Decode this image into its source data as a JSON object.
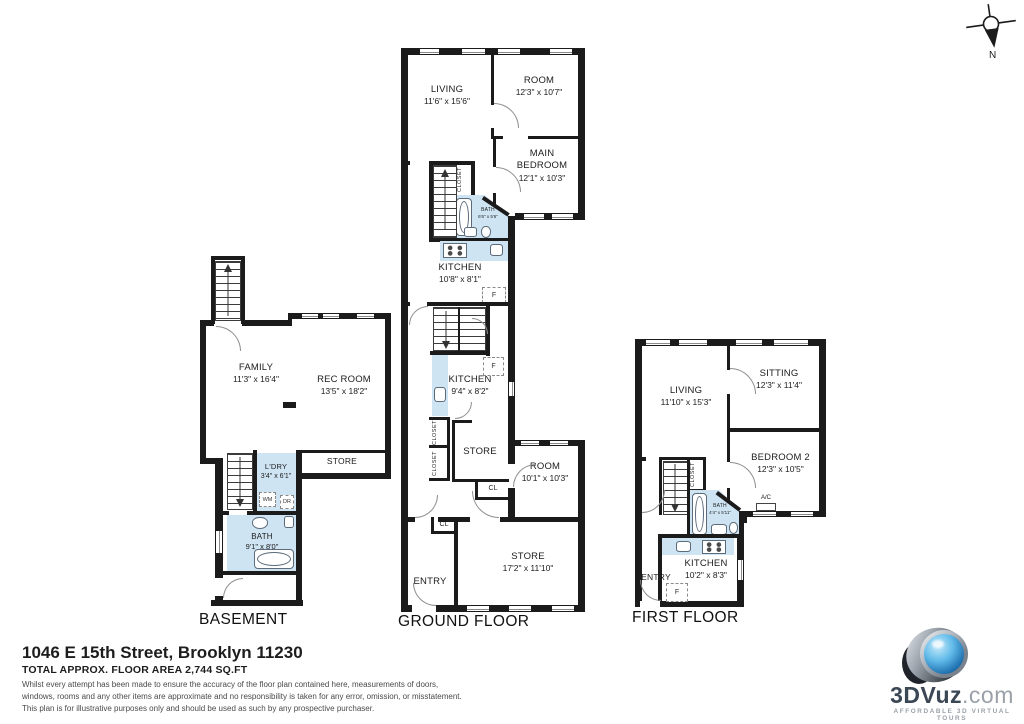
{
  "compass": {
    "label": "N"
  },
  "footer": {
    "address": "1046 E 15th Street, Brooklyn 11230",
    "area": "TOTAL APPROX. FLOOR AREA 2,744 SQ.FT",
    "disclaimer": [
      "Whilst every attempt has been made to ensure the accuracy of the floor plan contained here, measurements of doors,",
      "windows, rooms and any other items are approximate and no responsibility is taken for any error, omission, or misstatement.",
      "This plan is for illustrative purposes only and should be used as such by any prospective purchaser."
    ]
  },
  "logo": {
    "brand": "3DVuz",
    "suffix": ".com",
    "tagline": "AFFORDABLE 3D VIRTUAL TOURS"
  },
  "colors": {
    "wall": "#1b1b1b",
    "wet_area": "#cfe4f2"
  },
  "floors": {
    "basement": {
      "title": "BASEMENT",
      "family": {
        "name": "FAMILY",
        "dims": "11'3\" x 16'4\""
      },
      "rec": {
        "name": "REC ROOM",
        "dims": "13'5\" x 18'2\""
      },
      "store": "STORE",
      "ldry": {
        "name": "L'DRY",
        "dims": "3'4\" x 6'1\""
      },
      "wm": "WM",
      "dr": "DR",
      "bath": {
        "name": "BATH",
        "dims": "9'1\" x 8'0\""
      }
    },
    "ground": {
      "title": "GROUND FLOOR",
      "living": {
        "name": "LIVING",
        "dims": "11'6\" x 15'6\""
      },
      "room_top": {
        "name": "ROOM",
        "dims": "12'3\" x 10'7\""
      },
      "main_bedroom": {
        "line1": "MAIN",
        "line2": "BEDROOM",
        "dims": "12'1\" x 10'3\""
      },
      "bath": {
        "name": "BATH",
        "dims": "6'6\" x 5'6\""
      },
      "kitchen_up": {
        "name": "KITCHEN",
        "dims": "10'8\" x 8'1\""
      },
      "kitchen_low": {
        "name": "KITCHEN",
        "dims": "9'4\" x 8'2\""
      },
      "store_mid": "STORE",
      "room_low": {
        "name": "ROOM",
        "dims": "10'1\" x 10'3\""
      },
      "store_low": {
        "name": "STORE",
        "dims": "17'2\" x 11'10\""
      },
      "entry": "ENTRY",
      "closet": "CLOSET",
      "cl": "CL",
      "fridge": "F"
    },
    "first": {
      "title": "FIRST FLOOR",
      "living": {
        "name": "LIVING",
        "dims": "11'10\" x 15'3\""
      },
      "sitting": {
        "name": "SITTING",
        "dims": "12'3\" x 11'4\""
      },
      "bedroom2": {
        "name": "BEDROOM 2",
        "dims": "12'3\" x 10'5\""
      },
      "bath": {
        "name": "BATH",
        "dims": "4'4\" x 5'11\""
      },
      "kitchen": {
        "name": "KITCHEN",
        "dims": "10'2\" x 8'3\""
      },
      "entry": "ENTRY",
      "ac": "A/C",
      "closet": "CLOSET",
      "fridge": "F"
    }
  }
}
